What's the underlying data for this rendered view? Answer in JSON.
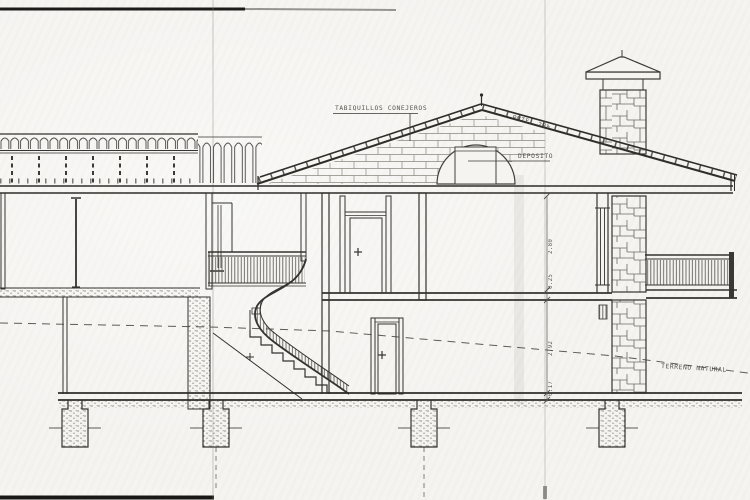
{
  "drawing": {
    "title": "building-cross-section",
    "labels": {
      "tabiquillos": "TABIQUILLOS CONEJEROS",
      "pendiente": "PNTE. 28%",
      "deposito": "DEPOSITO",
      "terreno": "TERRENO NATURAL"
    },
    "dimensions": {
      "upper_room_height": "2.80",
      "slab_thickness": "0.25",
      "lower_room_height": "2.92",
      "floor_thickness": "0.17"
    },
    "colors": {
      "paper": "#f5f4f1",
      "ink": "#35332f",
      "ink_light": "#6e6c66"
    }
  }
}
